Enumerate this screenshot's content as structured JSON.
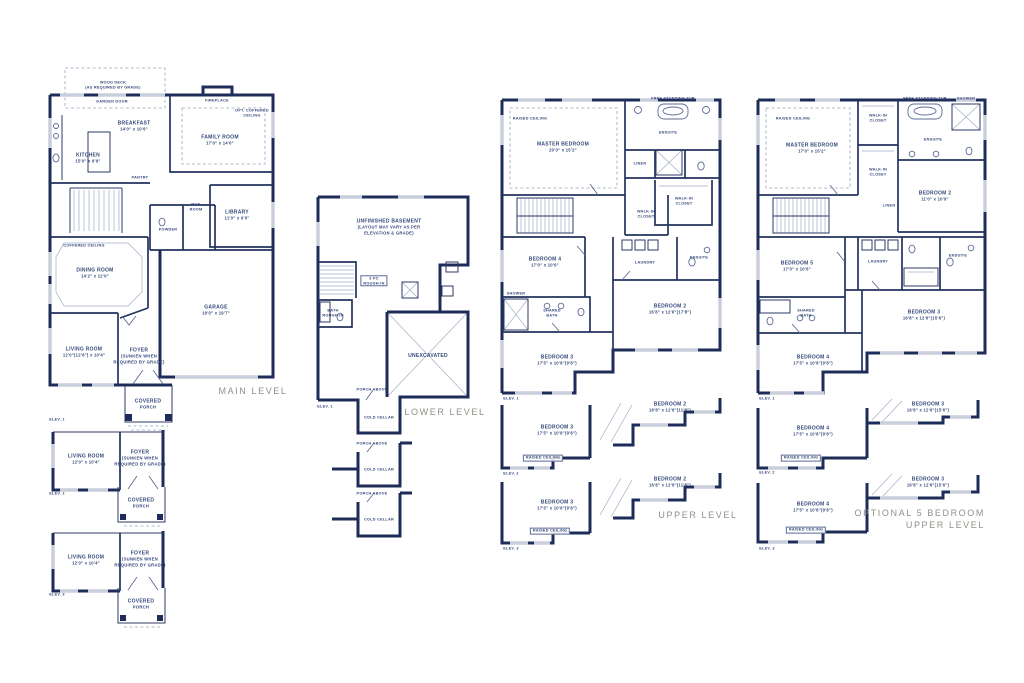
{
  "palette": {
    "wall_navy": "#1e2c5a",
    "window_gray": "#c9cedb",
    "room_label_blue": "#35497a",
    "level_title_gray": "#8f9087",
    "background": "#ffffff"
  },
  "levels": {
    "main": {
      "title": "MAIN LEVEL",
      "labels": [
        {
          "name": "wood-deck-note",
          "x": 113,
          "y": 85,
          "lines": [
            "WOOD DECK",
            "(AS REQUIRED BY GRADE)"
          ],
          "cls": "tiny"
        },
        {
          "name": "garden-door-note",
          "x": 112,
          "y": 102,
          "lines": [
            "GARDEN DOOR"
          ],
          "cls": "tiny"
        },
        {
          "name": "fireplace-note",
          "x": 217,
          "y": 101,
          "lines": [
            "FIREPLACE"
          ],
          "cls": "tiny"
        },
        {
          "name": "opt-coffered-ceiling-note",
          "x": 252,
          "y": 113,
          "lines": [
            "OPT. COFFERED",
            "CEILING"
          ],
          "cls": "tiny"
        },
        {
          "name": "room-kitchen",
          "x": 88,
          "y": 158,
          "lines": [
            "KITCHEN",
            "15'0\" x 8'9\""
          ]
        },
        {
          "name": "room-breakfast",
          "x": 134,
          "y": 126,
          "lines": [
            "BREAKFAST",
            "14'0\" x 10'6\""
          ]
        },
        {
          "name": "room-family",
          "x": 220,
          "y": 140,
          "lines": [
            "FAMILY ROOM",
            "17'0\" x 14'0\""
          ]
        },
        {
          "name": "room-library",
          "x": 237,
          "y": 215,
          "lines": [
            "LIBRARY",
            "11'0\" x 9'0\""
          ]
        },
        {
          "name": "room-powder",
          "x": 168,
          "y": 230,
          "lines": [
            "POWDER"
          ],
          "cls": "tiny"
        },
        {
          "name": "room-mud",
          "x": 196,
          "y": 207,
          "lines": [
            "MUD",
            "ROOM"
          ],
          "cls": "tiny"
        },
        {
          "name": "room-pantry",
          "x": 140,
          "y": 178,
          "lines": [
            "PANTRY"
          ],
          "cls": "tiny"
        },
        {
          "name": "room-dining",
          "x": 95,
          "y": 273,
          "lines": [
            "DINING ROOM",
            "14'2\" x 12'0\""
          ]
        },
        {
          "name": "coffered-ceiling-note",
          "x": 84,
          "y": 246,
          "lines": [
            "COFFERED CEILING"
          ],
          "cls": "tiny"
        },
        {
          "name": "room-garage",
          "x": 216,
          "y": 310,
          "lines": [
            "GARAGE",
            "19'0\" x 19'7\""
          ]
        },
        {
          "name": "room-living",
          "x": 84,
          "y": 352,
          "lines": [
            "LIVING ROOM",
            "12'0\"(12'6\") x 10'4\""
          ]
        },
        {
          "name": "room-foyer",
          "x": 139,
          "y": 356,
          "lines": [
            "FOYER",
            "(SUNKEN WHEN",
            "REQUIRED BY GRADE)"
          ]
        },
        {
          "name": "room-covered-porch",
          "x": 148,
          "y": 404,
          "lines": [
            "COVERED",
            "PORCH"
          ]
        },
        {
          "name": "elevation-label-1",
          "x": 57,
          "y": 420,
          "lines": [
            "ELEV. 1"
          ],
          "cls": "tiny"
        },
        {
          "name": "alt2-room-living",
          "x": 86,
          "y": 459,
          "lines": [
            "LIVING ROOM",
            "12'0\" x 10'4\""
          ]
        },
        {
          "name": "alt2-room-foyer",
          "x": 140,
          "y": 458,
          "lines": [
            "FOYER",
            "(SUNKEN WHEN",
            "REQUIRED BY GRADE)"
          ]
        },
        {
          "name": "alt2-room-covered-porch",
          "x": 141,
          "y": 503,
          "lines": [
            "COVERED",
            "PORCH"
          ]
        },
        {
          "name": "elevation-label-2",
          "x": 57,
          "y": 494,
          "lines": [
            "ELEV. 2"
          ],
          "cls": "tiny"
        },
        {
          "name": "alt3-room-living",
          "x": 86,
          "y": 560,
          "lines": [
            "LIVING ROOM",
            "12'0\" x 10'4\""
          ]
        },
        {
          "name": "alt3-room-foyer",
          "x": 140,
          "y": 559,
          "lines": [
            "FOYER",
            "(SUNKEN WHEN",
            "REQUIRED BY GRADE)"
          ]
        },
        {
          "name": "alt3-room-covered-porch",
          "x": 141,
          "y": 604,
          "lines": [
            "COVERED",
            "PORCH"
          ]
        },
        {
          "name": "elevation-label-3",
          "x": 57,
          "y": 595,
          "lines": [
            "ELEV. 3"
          ],
          "cls": "tiny"
        }
      ]
    },
    "lower": {
      "title": "LOWER LEVEL",
      "labels": [
        {
          "name": "room-unfinished-basement",
          "x": 389,
          "y": 227,
          "lines": [
            "UNFINISHED BASEMENT",
            "(LAYOUT MAY VARY AS PER",
            "ELEVATION & GRADE)"
          ]
        },
        {
          "name": "bath-rough-in-note",
          "x": 333,
          "y": 313,
          "lines": [
            "BATH",
            "ROUGH-IN"
          ],
          "cls": "tiny"
        },
        {
          "name": "three-pc-rough-in-note",
          "x": 374,
          "y": 281,
          "lines": [
            "3 PC",
            "ROUGH-IN"
          ],
          "cls": "tiny boxed"
        },
        {
          "name": "room-unexcavated",
          "x": 428,
          "y": 356,
          "lines": [
            "UNEXCAVATED"
          ]
        },
        {
          "name": "porch-above-note-1",
          "x": 372,
          "y": 390,
          "lines": [
            "PORCH ABOVE"
          ],
          "cls": "tiny"
        },
        {
          "name": "room-cold-cellar-1",
          "x": 379,
          "y": 418,
          "lines": [
            "COLD CELLAR"
          ],
          "cls": "tiny"
        },
        {
          "name": "lower-elevation-label-1",
          "x": 325,
          "y": 407,
          "lines": [
            "ELEV. 1"
          ],
          "cls": "tiny"
        },
        {
          "name": "porch-above-note-2",
          "x": 372,
          "y": 444,
          "lines": [
            "PORCH ABOVE"
          ],
          "cls": "tiny"
        },
        {
          "name": "room-cold-cellar-2",
          "x": 379,
          "y": 470,
          "lines": [
            "COLD CELLAR"
          ],
          "cls": "tiny"
        },
        {
          "name": "porch-above-note-3",
          "x": 372,
          "y": 494,
          "lines": [
            "PORCH ABOVE"
          ],
          "cls": "tiny"
        },
        {
          "name": "room-cold-cellar-3",
          "x": 379,
          "y": 520,
          "lines": [
            "COLD CELLAR"
          ],
          "cls": "tiny"
        }
      ]
    },
    "upper": {
      "title": "UPPER LEVEL",
      "labels": [
        {
          "name": "raised-ceiling-note",
          "x": 530,
          "y": 119,
          "lines": [
            "RAISED CEILING"
          ],
          "cls": "tiny"
        },
        {
          "name": "room-master-bedroom",
          "x": 563,
          "y": 147,
          "lines": [
            "MASTER BEDROOM",
            "20'0\" x 15'2\""
          ]
        },
        {
          "name": "free-standing-tub-note",
          "x": 673,
          "y": 99,
          "lines": [
            "FREE STANDING TUB"
          ],
          "cls": "tiny"
        },
        {
          "name": "room-ensuite",
          "x": 668,
          "y": 133,
          "lines": [
            "ENSUITE"
          ],
          "cls": "tiny"
        },
        {
          "name": "linen-note",
          "x": 640,
          "y": 164,
          "lines": [
            "LINEN"
          ],
          "cls": "tiny"
        },
        {
          "name": "room-walk-in-closet-a",
          "x": 684,
          "y": 201,
          "lines": [
            "WALK-IN",
            "CLOSET"
          ],
          "cls": "tiny"
        },
        {
          "name": "room-walk-in-closet-b",
          "x": 646,
          "y": 214,
          "lines": [
            "WALK-IN",
            "CLOSET"
          ],
          "cls": "tiny"
        },
        {
          "name": "room-bedroom-4",
          "x": 545,
          "y": 262,
          "lines": [
            "BEDROOM 4",
            "17'0\" x 10'6\""
          ]
        },
        {
          "name": "room-laundry",
          "x": 645,
          "y": 263,
          "lines": [
            "LAUNDRY"
          ],
          "cls": "tiny"
        },
        {
          "name": "room-ensuite-2",
          "x": 699,
          "y": 258,
          "lines": [
            "ENSUITE"
          ],
          "cls": "tiny"
        },
        {
          "name": "room-bedroom-2",
          "x": 670,
          "y": 309,
          "lines": [
            "BEDROOM 2",
            "16'8\" x 12'6\"(17'8\")"
          ]
        },
        {
          "name": "shower-note",
          "x": 516,
          "y": 294,
          "lines": [
            "SHOWER"
          ],
          "cls": "tiny"
        },
        {
          "name": "room-shared-bath",
          "x": 552,
          "y": 313,
          "lines": [
            "SHARED",
            "BATH"
          ],
          "cls": "tiny"
        },
        {
          "name": "room-bedroom-3",
          "x": 557,
          "y": 360,
          "lines": [
            "BEDROOM 3",
            "17'5\" x 10'8\"(9'8\")"
          ]
        },
        {
          "name": "upper-elevation-label-1",
          "x": 511,
          "y": 399,
          "lines": [
            "ELEV. 1"
          ],
          "cls": "tiny"
        },
        {
          "name": "alt2-room-bedroom-2",
          "x": 670,
          "y": 407,
          "lines": [
            "BEDROOM 2",
            "16'8\" x 12'6\"(11'8\")"
          ]
        },
        {
          "name": "alt2-room-bedroom-3",
          "x": 557,
          "y": 430,
          "lines": [
            "BEDROOM 3",
            "17'5\" x 10'8\"(9'8\")"
          ]
        },
        {
          "name": "alt2-raised-ceiling-note",
          "x": 543,
          "y": 458,
          "lines": [
            "RAISED CEILING"
          ],
          "cls": "tiny boxed"
        },
        {
          "name": "upper-elevation-label-2",
          "x": 511,
          "y": 474,
          "lines": [
            "ELEV. 2"
          ],
          "cls": "tiny"
        },
        {
          "name": "alt3-room-bedroom-2",
          "x": 670,
          "y": 482,
          "lines": [
            "BEDROOM 2",
            "16'8\" x 12'6\"(11'8\")"
          ]
        },
        {
          "name": "alt3-room-bedroom-3",
          "x": 557,
          "y": 505,
          "lines": [
            "BEDROOM 3",
            "17'5\" x 10'8\"(9'8\")"
          ]
        },
        {
          "name": "alt3-raised-ceiling-note",
          "x": 550,
          "y": 531,
          "lines": [
            "RAISED CEILING"
          ],
          "cls": "tiny boxed"
        },
        {
          "name": "upper-elevation-label-3",
          "x": 511,
          "y": 549,
          "lines": [
            "ELEV. 3"
          ],
          "cls": "tiny"
        }
      ]
    },
    "optional": {
      "title_line1": "OPTIONAL 5 BEDROOM",
      "title_line2": "UPPER LEVEL",
      "labels": [
        {
          "name": "raised-ceiling-note",
          "x": 793,
          "y": 119,
          "lines": [
            "RAISED CEILING"
          ],
          "cls": "tiny"
        },
        {
          "name": "room-master-bedroom",
          "x": 812,
          "y": 148,
          "lines": [
            "MASTER BEDROOM",
            "17'0\" x 15'2\""
          ]
        },
        {
          "name": "room-walk-in-closet-a",
          "x": 878,
          "y": 118,
          "lines": [
            "WALK-IN",
            "CLOSET"
          ],
          "cls": "tiny"
        },
        {
          "name": "room-walk-in-closet-b",
          "x": 878,
          "y": 172,
          "lines": [
            "WALK-IN",
            "CLOSET"
          ],
          "cls": "tiny"
        },
        {
          "name": "free-standing-tub-note",
          "x": 925,
          "y": 99,
          "lines": [
            "FREE STANDING TUB"
          ],
          "cls": "tiny"
        },
        {
          "name": "shower-note",
          "x": 966,
          "y": 99,
          "lines": [
            "SHOWER"
          ],
          "cls": "tiny"
        },
        {
          "name": "room-ensuite",
          "x": 933,
          "y": 140,
          "lines": [
            "ENSUITE"
          ],
          "cls": "tiny"
        },
        {
          "name": "room-bedroom-2",
          "x": 935,
          "y": 196,
          "lines": [
            "BEDROOM 2",
            "11'0\" x 10'9\""
          ]
        },
        {
          "name": "linen-note",
          "x": 889,
          "y": 206,
          "lines": [
            "LINEN"
          ],
          "cls": "tiny"
        },
        {
          "name": "room-bedroom-5",
          "x": 797,
          "y": 266,
          "lines": [
            "BEDROOM 5",
            "17'0\" x 10'6\""
          ]
        },
        {
          "name": "room-laundry",
          "x": 878,
          "y": 262,
          "lines": [
            "LAUNDRY"
          ],
          "cls": "tiny"
        },
        {
          "name": "room-ensuite-2",
          "x": 958,
          "y": 256,
          "lines": [
            "ENSUITE"
          ],
          "cls": "tiny"
        },
        {
          "name": "room-shared-bath",
          "x": 806,
          "y": 313,
          "lines": [
            "SHARED",
            "BATH"
          ],
          "cls": "tiny"
        },
        {
          "name": "room-bedroom-3",
          "x": 924,
          "y": 315,
          "lines": [
            "BEDROOM 3",
            "16'8\" x 12'6\"(15'6\")"
          ]
        },
        {
          "name": "room-bedroom-4",
          "x": 813,
          "y": 360,
          "lines": [
            "BEDROOM 4",
            "17'5\" x 10'8\"(9'8\")"
          ]
        },
        {
          "name": "optional-elevation-label-1",
          "x": 767,
          "y": 399,
          "lines": [
            "ELEV. 1"
          ],
          "cls": "tiny"
        },
        {
          "name": "alt2-room-bedroom-3",
          "x": 928,
          "y": 407,
          "lines": [
            "BEDROOM 3",
            "16'8\" x 12'6\"(15'6\")"
          ]
        },
        {
          "name": "alt2-room-bedroom-4",
          "x": 813,
          "y": 431,
          "lines": [
            "BEDROOM 4",
            "17'5\" x 10'8\"(9'8\")"
          ]
        },
        {
          "name": "alt2-raised-ceiling-note",
          "x": 801,
          "y": 458,
          "lines": [
            "RAISED CEILING"
          ],
          "cls": "tiny boxed"
        },
        {
          "name": "optional-elevation-label-2",
          "x": 767,
          "y": 473,
          "lines": [
            "ELEV. 2"
          ],
          "cls": "tiny"
        },
        {
          "name": "alt3-room-bedroom-3",
          "x": 928,
          "y": 482,
          "lines": [
            "BEDROOM 3",
            "16'8\" x 12'6\"(15'6\")"
          ]
        },
        {
          "name": "alt3-room-bedroom-4",
          "x": 813,
          "y": 507,
          "lines": [
            "BEDROOM 4",
            "17'5\" x 10'8\"(9'8\")"
          ]
        },
        {
          "name": "alt3-raised-ceiling-note",
          "x": 806,
          "y": 530,
          "lines": [
            "RAISED CEILING"
          ],
          "cls": "tiny boxed"
        },
        {
          "name": "optional-elevation-label-3",
          "x": 767,
          "y": 549,
          "lines": [
            "ELEV. 3"
          ],
          "cls": "tiny"
        }
      ]
    }
  }
}
